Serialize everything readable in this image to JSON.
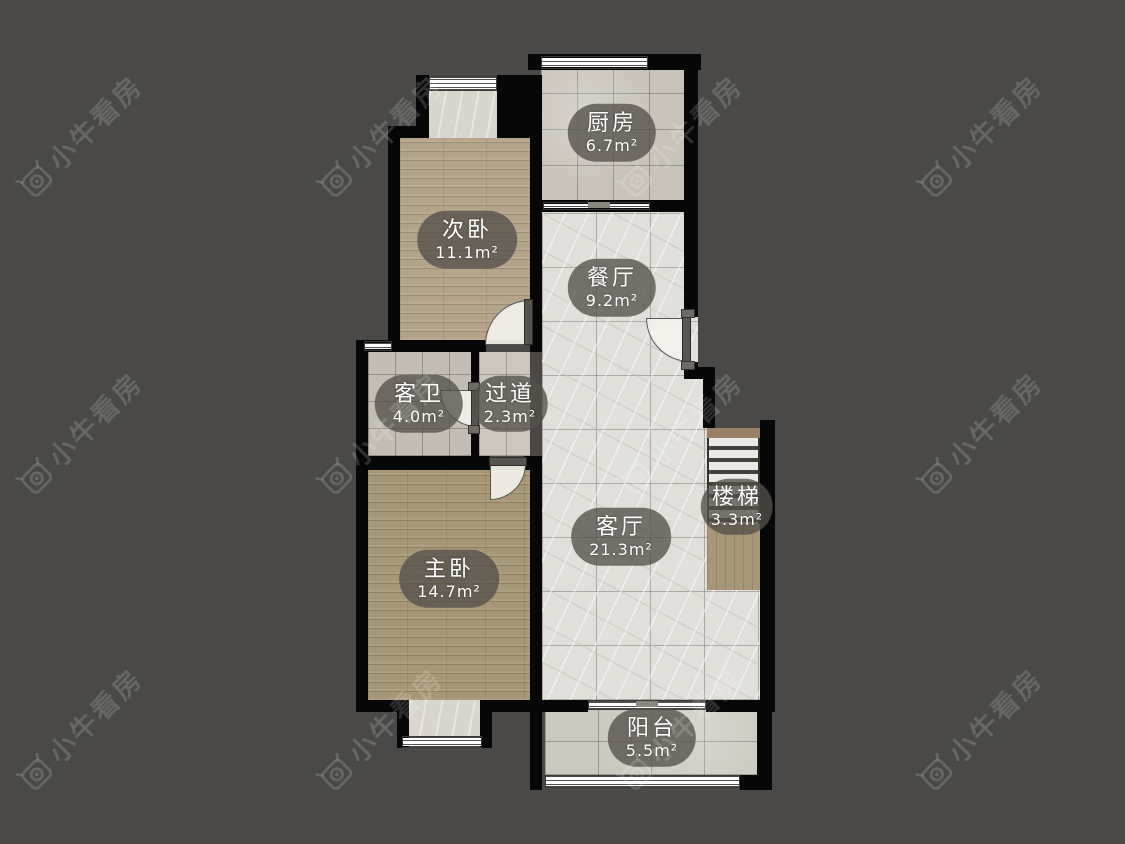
{
  "watermark": {
    "text": "小牛看房",
    "logo": "bull-camera-logo"
  },
  "rooms": [
    {
      "id": "kitchen",
      "name": "厨房",
      "area": "6.7m²"
    },
    {
      "id": "bedroom2",
      "name": "次卧",
      "area": "11.1m²"
    },
    {
      "id": "dining",
      "name": "餐厅",
      "area": "9.2m²"
    },
    {
      "id": "bath",
      "name": "客卫",
      "area": "4.0m²"
    },
    {
      "id": "hallway",
      "name": "过道",
      "area": "2.3m²"
    },
    {
      "id": "stairs",
      "name": "楼梯",
      "area": "3.3m²"
    },
    {
      "id": "living",
      "name": "客厅",
      "area": "21.3m²"
    },
    {
      "id": "master",
      "name": "主卧",
      "area": "14.7m²"
    },
    {
      "id": "balcony",
      "name": "阳台",
      "area": "5.5m²"
    }
  ],
  "colors": {
    "bg": "#4a4947",
    "wall": "#070707",
    "wood1": "#b6a489",
    "wood2": "#a89776",
    "tile-kitchen": "#c8c3b9",
    "tile-bath": "#c3beb4",
    "tile-hall": "#ccc7bd",
    "tile-alcove": "#d9d5cd",
    "tile-balcony": "#cbc8be",
    "marble": "#e1dfda",
    "stair-beam": "#9a8165",
    "bubble": "rgba(84,79,73,0.78)",
    "watermark": "rgba(255,255,255,0.16)"
  }
}
